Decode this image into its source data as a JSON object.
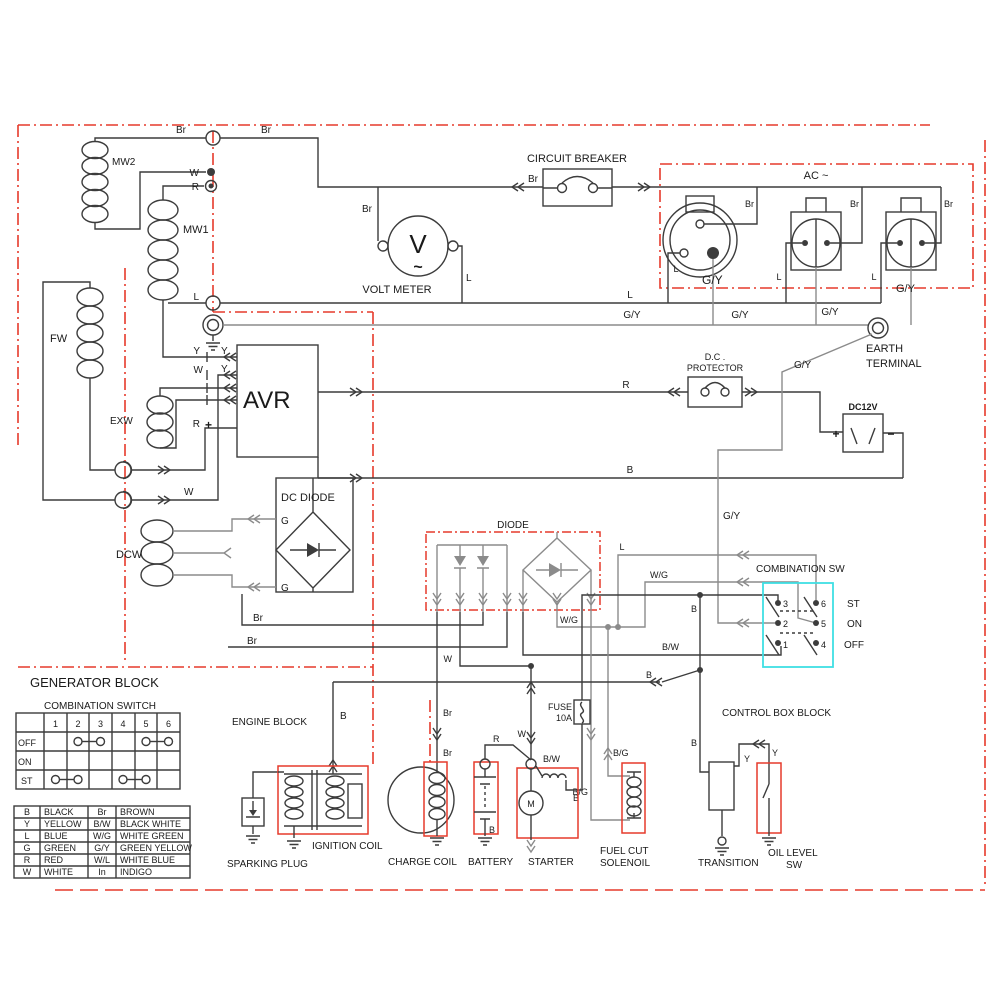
{
  "colors": {
    "boundary_red": "#e63a2b",
    "highlight_cyan": "#3fdfe4",
    "wire_dark": "#3c3c3c",
    "wire_gray": "#8b8b8b"
  },
  "blocks": {
    "generator": "GENERATOR BLOCK",
    "engine": "ENGINE BLOCK",
    "control_box": "CONTROL BOX BLOCK"
  },
  "c": {
    "mw2": "MW2",
    "mw1": "MW1",
    "fw": "FW",
    "exw": "EXW",
    "dcw": "DCW",
    "avr": "AVR",
    "circuit_breaker": "CIRCUIT BREAKER",
    "volt_meter": "VOLT METER",
    "volt_v": "V",
    "volt_sine": "~",
    "ac": "AC ~",
    "earth_1": "EARTH",
    "earth_2": "TERMINAL",
    "dc_protector_1": "D.C .",
    "dc_protector_2": "PROTECTOR",
    "dc12v": "DC12V",
    "plus": "+",
    "minus": "−",
    "dc_diode": "DC DIODE",
    "diode": "DIODE",
    "fuse": "FUSE",
    "fuse_rating": "10A",
    "sparking_plug": "SPARKING PLUG",
    "ignition_coil": "IGNITION COIL",
    "charge_coil": "CHARGE COIL",
    "battery": "BATTERY",
    "starter": "STARTER",
    "motor_m": "M",
    "fuel_cut_1": "FUEL CUT",
    "fuel_cut_2": "SOLENOIL",
    "transition": "TRANSITION",
    "oil_level_1": "OIL LEVEL",
    "oil_level_2": "SW"
  },
  "w": {
    "b": "B",
    "br": "Br",
    "w": "W",
    "r": "R",
    "l": "L",
    "g": "G",
    "y": "Y",
    "gy": "G/Y",
    "wg": "W/G",
    "bw": "B/W",
    "bg": "B/G"
  },
  "sw": {
    "label": "COMBINATION SW",
    "pos_st": "ST",
    "pos_on": "ON",
    "pos_off": "OFF",
    "pins": [
      "1",
      "2",
      "3",
      "4",
      "5",
      "6"
    ]
  },
  "sw_table": {
    "title": "COMBINATION SWITCH",
    "headers": [
      "1",
      "2",
      "3",
      "4",
      "5",
      "6"
    ],
    "row_labels": [
      "OFF",
      "ON",
      "ST"
    ],
    "connections": {
      "OFF": [
        [
          2,
          3
        ],
        [
          5,
          6
        ]
      ],
      "ON": [],
      "ST": [
        [
          1,
          2
        ],
        [
          4,
          5
        ]
      ]
    }
  },
  "legend": {
    "rows": [
      [
        "B",
        "BLACK",
        "Br",
        "BROWN"
      ],
      [
        "Y",
        "YELLOW",
        "B/W",
        "BLACK WHITE"
      ],
      [
        "L",
        "BLUE",
        "W/G",
        "WHITE GREEN"
      ],
      [
        "G",
        "GREEN",
        "G/Y",
        "GREEN YELLOW"
      ],
      [
        "R",
        "RED",
        "W/L",
        "WHITE BLUE"
      ],
      [
        "W",
        "WHITE",
        "In",
        "INDIGO"
      ]
    ]
  }
}
